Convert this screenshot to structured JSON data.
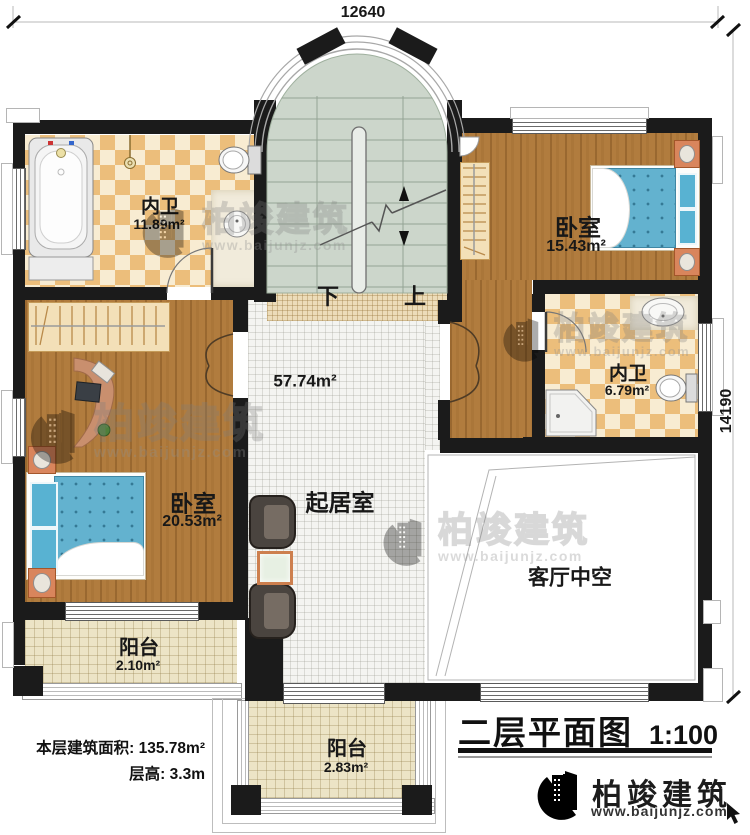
{
  "dimensions": {
    "top": "12640",
    "right": "14190"
  },
  "stairs": {
    "down": "下",
    "up": "上"
  },
  "rooms": {
    "bath_top": {
      "name": "内卫",
      "area": "11.89m²"
    },
    "bedroom_top": {
      "name": "卧室",
      "area": "15.43m²"
    },
    "bath_right": {
      "name": "内卫",
      "area": "6.79m²"
    },
    "bedroom_left": {
      "name": "卧室",
      "area": "20.53m²"
    },
    "living": {
      "name": "起居室",
      "area": "57.74m²"
    },
    "void": {
      "name": "客厅中空"
    },
    "balcony_left": {
      "name": "阳台",
      "area": "2.10m²"
    },
    "balcony_bottom": {
      "name": "阳台",
      "area": "2.83m²"
    }
  },
  "footer": {
    "floor_area_label": "本层建筑面积:",
    "floor_area_value": "135.78m²",
    "floor_height_label": "层高:",
    "floor_height_value": "3.3m"
  },
  "title_block": {
    "title": "二层平面图",
    "scale": "1:100"
  },
  "brand": {
    "name": "柏竣建筑",
    "url": "www.baijunjz.com"
  },
  "colors": {
    "wall": "#1b1b1b",
    "wood": "#b17c3e",
    "checker_dark": "#ecbe7b",
    "checker_light": "#f8ecd2",
    "stair_floor": "#ccd6cb",
    "mattress_blue": "#63b2cf",
    "accent_orange": "#d9855c",
    "brand_blue": "#1e56a0",
    "brand_orange": "#f08519"
  }
}
